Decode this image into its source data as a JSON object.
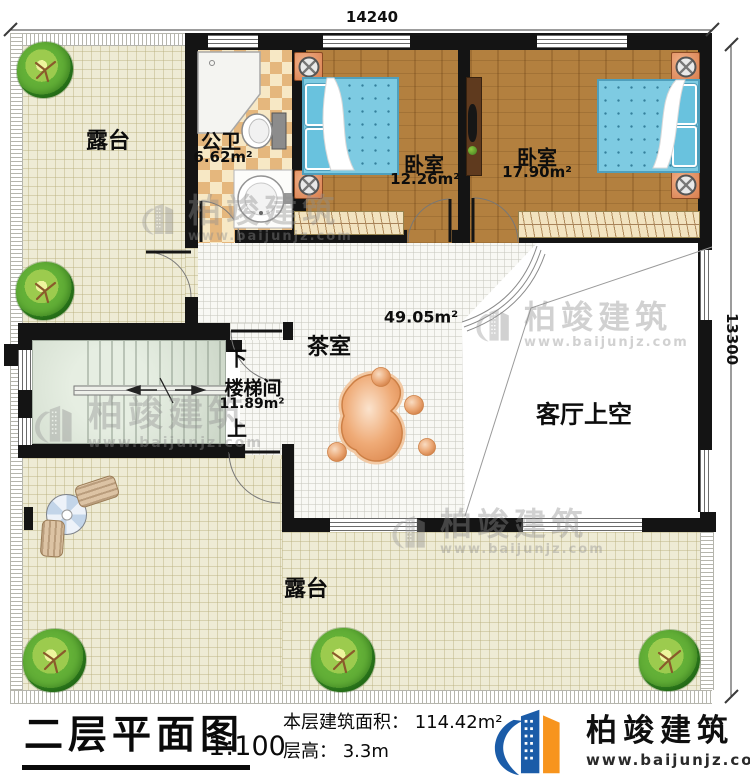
{
  "dimensions": {
    "width": "14240",
    "height": "13300"
  },
  "rooms": {
    "terrace_top": {
      "label": "露台"
    },
    "bathroom": {
      "label": "公卫",
      "area": "6.62m²"
    },
    "bedroom_left": {
      "label": "卧室",
      "area": "12.26m²"
    },
    "bedroom_right": {
      "label": "卧室",
      "area": "17.90m²"
    },
    "tea_room": {
      "label": "茶室",
      "area": "49.05m²"
    },
    "stairwell": {
      "label": "楼梯间",
      "area": "11.89m²",
      "down": "下",
      "up": "上"
    },
    "living_void": {
      "label": "客厅上空"
    },
    "terrace_bottom": {
      "label": "露台"
    }
  },
  "footer": {
    "title": "二层平面图",
    "scale": "1:100",
    "floor_area": "本层建筑面积： 114.42m²",
    "floor_height": "层高： 3.3m"
  },
  "brand": {
    "name": "柏竣建筑",
    "url": "www.baijunjz.com"
  },
  "watermark": {
    "name": "柏竣建筑",
    "url": "www.baijunjz.com"
  },
  "colors": {
    "wall": "#141414",
    "wood": "#b3803f",
    "terrace": "#eeebd5",
    "tile": "#f8f8f4",
    "bed": "#7ecbe2",
    "stair": "#d5dfd1",
    "logo_blue": "#1b5ca8",
    "logo_orange": "#f7941d"
  }
}
